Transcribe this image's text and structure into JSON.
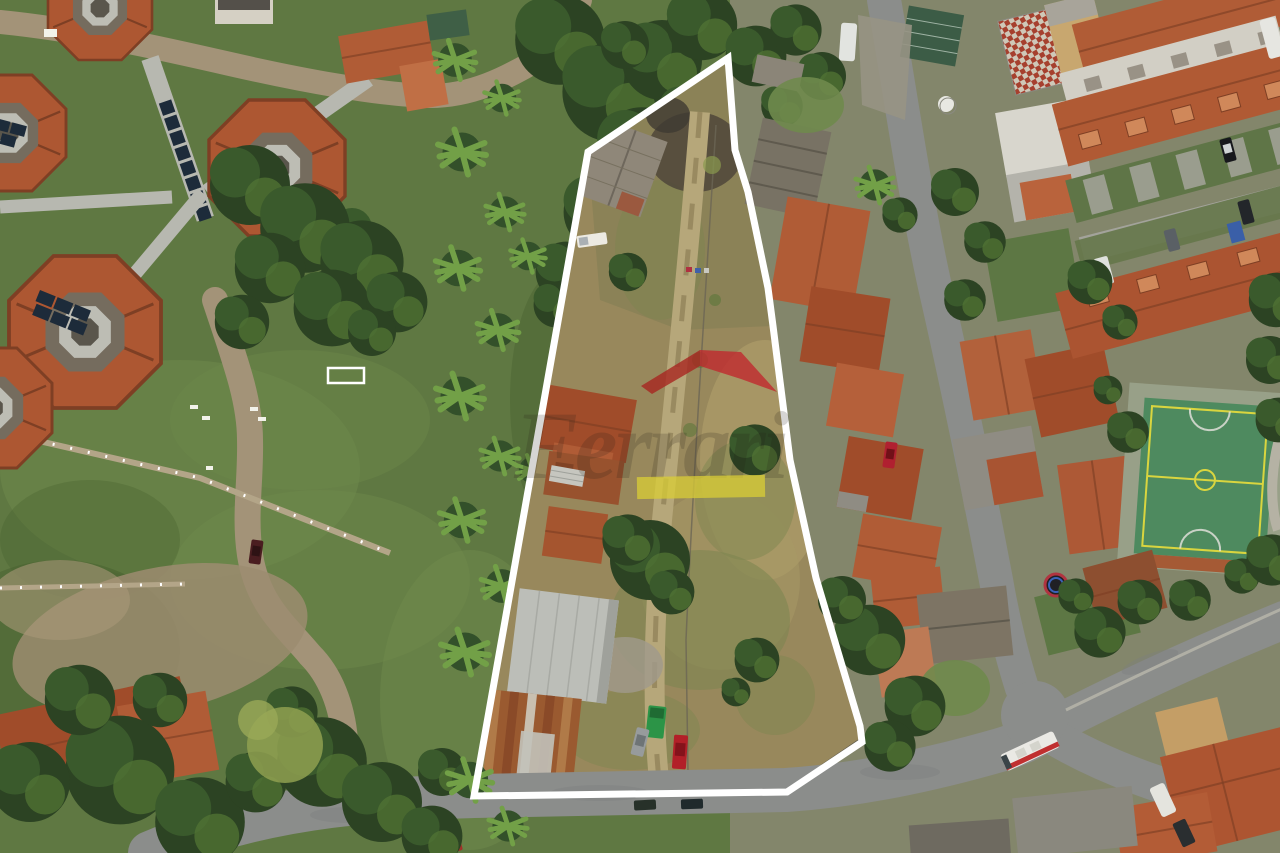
{
  "image": {
    "description": "Aerial drone photograph of a long trapezoidal land plot outlined in white, between a green institutional campus with octagonal pavilions on the left and a dense terracotta-roofed residential neighborhood on the right",
    "width_px": 1280,
    "height_px": 853
  },
  "boundary": {
    "points": "728,58 735,150 748,192 768,288 773,326 790,460 816,578 860,726 862,742 787,792 474,796 588,152",
    "stroke_color": "#ffffff",
    "stroke_width": 7
  },
  "watermark": {
    "text": "Ferrari",
    "logo_roof_color": "#c1272d",
    "logo_bar_color": "#d9ce35",
    "text_color": "#241e16"
  },
  "palette": {
    "grass": "#5f7842",
    "tree_dark": "#2c4323",
    "palm_green": "#72a047",
    "dry_lot": "#98885c",
    "burnt_ground": "#4b4238",
    "terracotta_roof": "#b05c36",
    "asphalt_road": "#8b8d8b",
    "concrete_walkway": "#b7b8b0",
    "solar_panel": "#1d2b3a",
    "court_green": "#4e8a5f",
    "court_lines": "#d9d53f",
    "boundary_white": "#ffffff"
  },
  "vehicles": {
    "bus_body": "#eae9e4",
    "bus_stripe": "#c03030",
    "red_car": "#b22028",
    "green_truck": "#2c9447",
    "white_pickup": "#eceae2"
  }
}
